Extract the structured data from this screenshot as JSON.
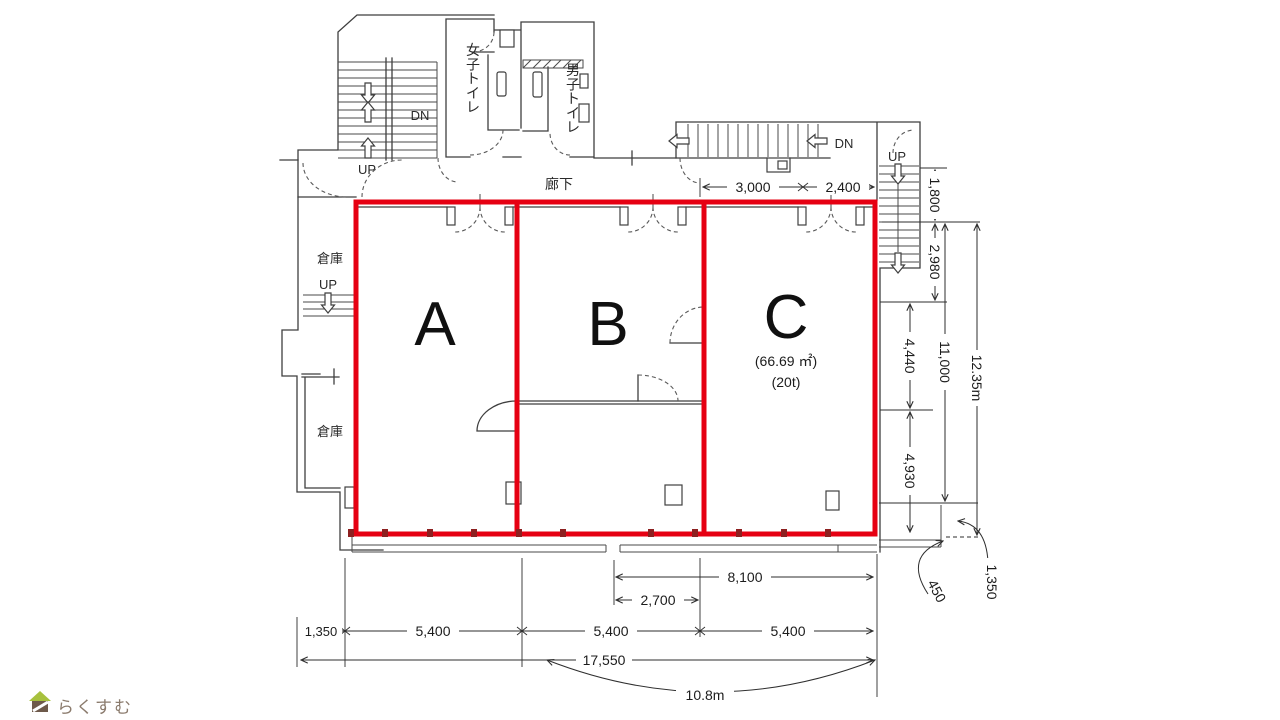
{
  "plan": {
    "rooms": [
      {
        "id": "A",
        "label": "A"
      },
      {
        "id": "B",
        "label": "B"
      },
      {
        "id": "C",
        "label": "C",
        "area": "(66.69 ㎡)",
        "load": "(20t)"
      }
    ],
    "facility": {
      "toilet_women": "女子トイレ",
      "toilet_men": "男子トイレ",
      "corridor": "廊下",
      "storage_upper": "倉庫",
      "storage_lower": "倉庫"
    },
    "stairs": {
      "up": "UP",
      "dn": "DN"
    },
    "dimensions": {
      "top": {
        "w1": "3,000",
        "w2": "2,400"
      },
      "right": {
        "h1": "1,800",
        "h2": "2,980",
        "h3": "4,440",
        "h4": "4,930",
        "sub": "11,000",
        "total": "12.35m",
        "offset": "1,350",
        "step": "450"
      },
      "bottom": {
        "offset": "1,350",
        "w1": "5,400",
        "w2": "5,400",
        "w3": "5,400",
        "total": "17,550",
        "inner1": "2,700",
        "inner2": "8,100",
        "span": "10.8m"
      }
    }
  },
  "logo": {
    "text": "らくすむ"
  },
  "colors": {
    "highlight_red": "#e60012",
    "line": "#3f3f3f",
    "logo_text": "#8b7b6d",
    "logo_roof": "#a7c13d",
    "logo_body": "#6e5a4b"
  }
}
